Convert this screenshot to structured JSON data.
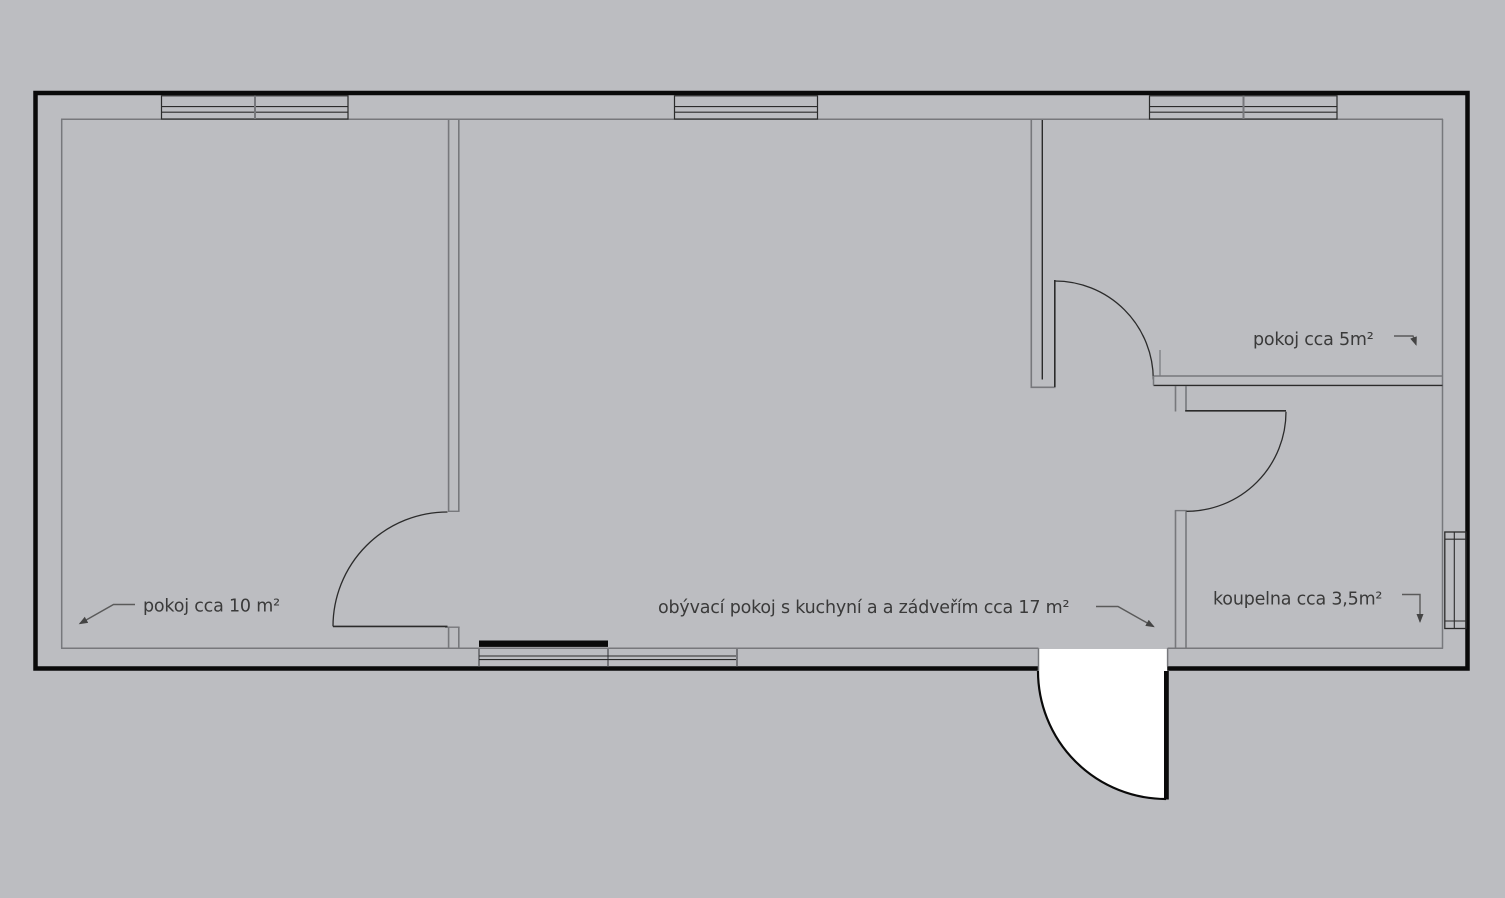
{
  "title": "floor plan",
  "colors": {
    "background": "#bcbdc1",
    "floor": "#ffffff",
    "outer_wall": "#0a0a0a",
    "inner_wall_line": "#77787c",
    "detail_line": "#2b2b2b",
    "label_text": "#3a3a3a",
    "window_sill": "#0a0a0a"
  },
  "rooms": [
    {
      "id": "room-left",
      "label": "pokoj cca 10 m²"
    },
    {
      "id": "living",
      "label": "obývací pokoj s kuchyní a a zádveřím cca 17 m²"
    },
    {
      "id": "small-room",
      "label": "pokoj cca 5m²"
    },
    {
      "id": "bathroom",
      "label": "koupelna cca 3,5m²"
    }
  ]
}
